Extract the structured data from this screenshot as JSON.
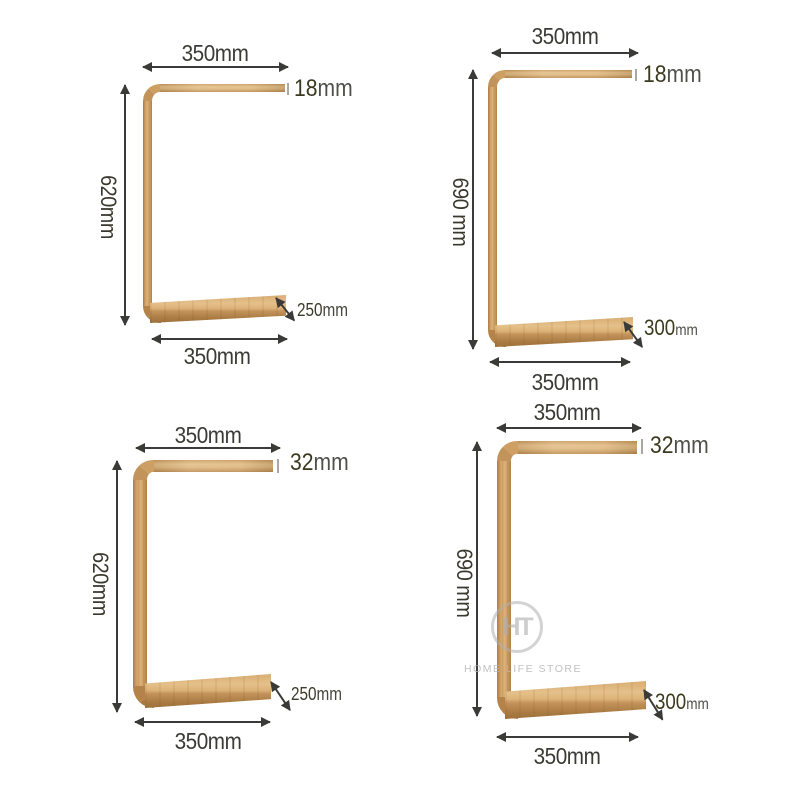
{
  "watermark": {
    "monogram": "HT",
    "label": "HOME LIFE STORE"
  },
  "panels": {
    "top_left": {
      "top_width": "350mm",
      "thickness_num": "18",
      "thickness_unit": "mm",
      "height": "620mm",
      "depth_num": "250",
      "depth_unit": "mm",
      "bottom_width": "350mm"
    },
    "top_right": {
      "top_width": "350mm",
      "thickness_num": "18",
      "thickness_unit": "mm",
      "height": "690 mm",
      "depth_num": "300",
      "depth_unit": "mm",
      "bottom_width": "350mm"
    },
    "bottom_left": {
      "top_width": "350mm",
      "thickness_num": "32",
      "thickness_unit": "mm",
      "height": "620mm",
      "depth_num": "250",
      "depth_unit": "mm",
      "bottom_width": "350mm"
    },
    "bottom_right": {
      "top_width": "350mm",
      "thickness_num": "32",
      "thickness_unit": "mm",
      "height": "690 mm",
      "depth_num": "300",
      "depth_unit": "mm",
      "bottom_width": "350mm"
    }
  },
  "colors": {
    "wood_mid": "#d2a56b",
    "wood_dark": "#aa7c44",
    "dimension_line": "#3a3a38",
    "number_accent": "#3b3a1f"
  }
}
